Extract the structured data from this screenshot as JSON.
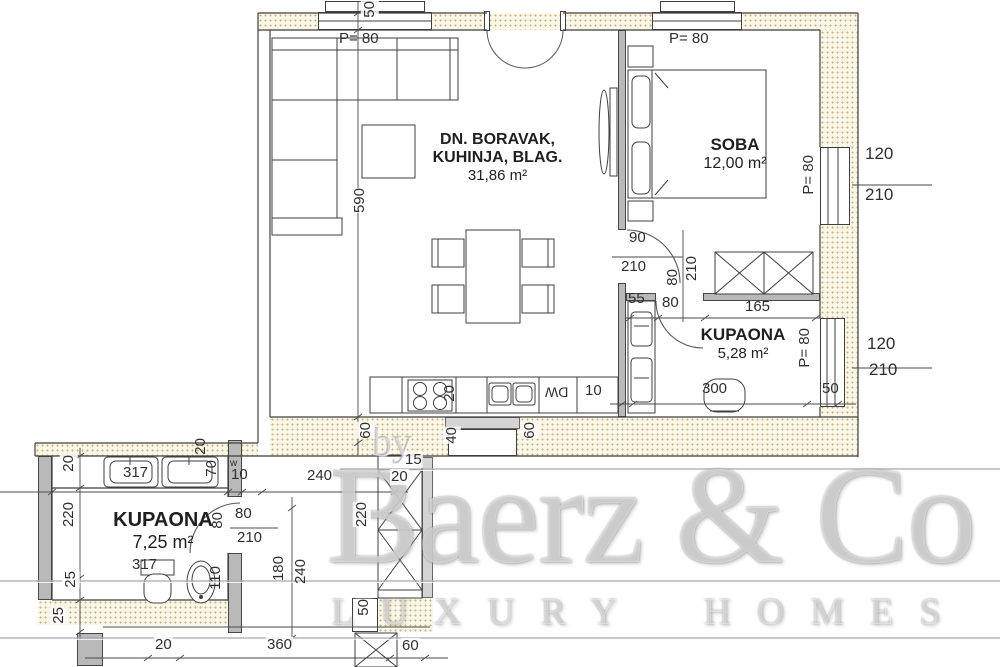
{
  "meta": {
    "type": "floor-plan",
    "colors": {
      "wall_hatch_dot": "#c9ae77",
      "wall_hatch_bg": "#faf6e8",
      "wall_gray": "#b9b9b9",
      "line": "#3f3f3f",
      "watermark": "#cccccc"
    }
  },
  "rooms": {
    "living": {
      "line1": "DN. BORAVAK,",
      "line2": "KUHINJA, BLAG.",
      "area": "31,86 m²"
    },
    "bedroom": {
      "name": "SOBA",
      "area": "12,00 m²"
    },
    "bath1": {
      "name": "KUPAONA",
      "area": "5,28 m²"
    },
    "bath2": {
      "name": "KUPAONA",
      "area": "7,25 m²"
    }
  },
  "dims": {
    "w50": "50",
    "p80a": "P= 80",
    "p80b": "P= 80",
    "d590": "590",
    "p80r1": "P= 80",
    "s120": "120",
    "s210": "210",
    "dr90": "90",
    "dr210": "210",
    "dv80": "80",
    "dv210": "210",
    "b55": "55",
    "b80": "80",
    "b165": "165",
    "p80r2": "P= 80",
    "w120": "120",
    "w210": "210",
    "b300": "300",
    "b50": "50",
    "k10": "10",
    "k20": "20",
    "dw": "DW",
    "v60a": "60",
    "v40": "40",
    "v60b": "60",
    "s15": "15",
    "s20": "20",
    "h240": "240",
    "sv220": "220",
    "sv50": "50",
    "s60": "60",
    "h360": "360",
    "h20": "20",
    "a20": "20",
    "a220": "220",
    "a25a": "25",
    "a25b": "25",
    "t317a": "317",
    "t317b": "317",
    "a110": "110",
    "a70": "70",
    "a10": "10",
    "a20t": "20",
    "aw": "w",
    "a80": "80",
    "a210": "210",
    "a80v": "80",
    "a180": "180",
    "a240": "240"
  },
  "watermark": {
    "by": "by",
    "brand": "Baerz & Co",
    "tagline": "LUXURY HOMES"
  }
}
